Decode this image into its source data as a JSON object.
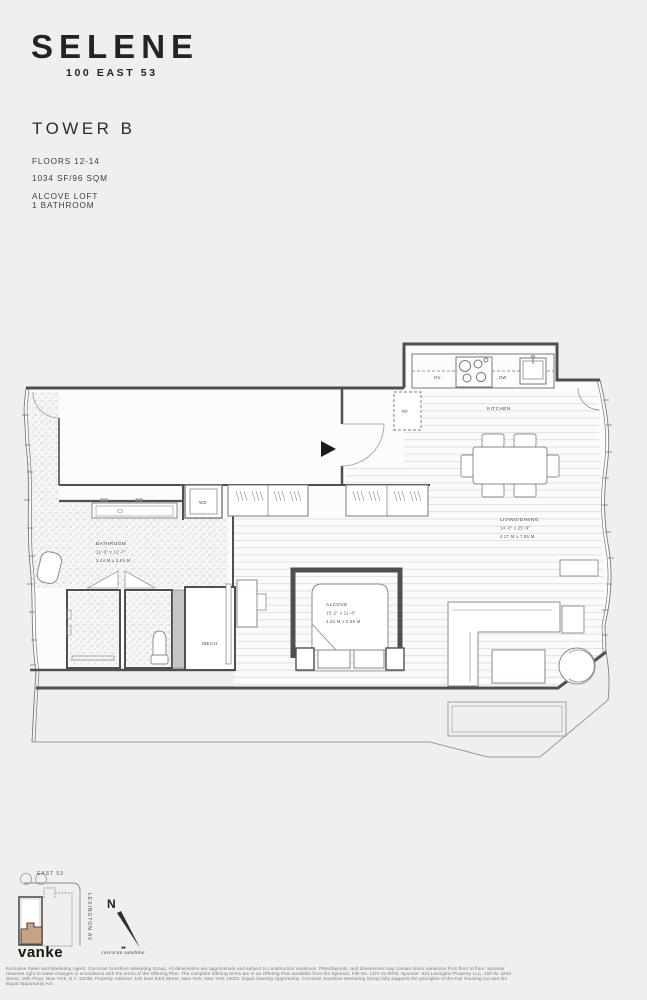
{
  "header": {
    "brand": "SELENE",
    "address": "100 EAST 53",
    "tower": "TOWER B",
    "floors": "FLOORS 12-14",
    "area": "1034 SF/96 SQM",
    "type1": "ALCOVE LOFT",
    "type2": "1 BATHROOM"
  },
  "plan": {
    "labels": {
      "kitchen": "KITCHEN",
      "living_name": "LIVING/DINING",
      "living_ft": "14'-0\" x 25'-9\"",
      "living_m": "4.27 M x 7.85 M",
      "alcove_name": "ALCOVE",
      "alcove_ft": "15'-2\" x 11'-8\"",
      "alcove_m": "4.62 M x 3.56 M",
      "bathroom_name": "BATHROOM",
      "bathroom_ft": "11'-3\" x 12'-7\"",
      "bathroom_m": "3.44 M x 3.84 M",
      "mech": "MECH",
      "wd": "WD",
      "rf": "RF",
      "ov": "OV",
      "dw": "DW"
    }
  },
  "keyplan": {
    "street_top": "EAST 53",
    "street_right": "LEXINGTON AV",
    "north_label": "N",
    "highlight_color": "#c9a183"
  },
  "footer": {
    "brand_logo": "vanke",
    "agency_dots": "●●",
    "agency_logo": "corcoran sunshine",
    "disclaimer": "Exclusive Sales and Marketing Agent: Corcoran Sunshine Marketing Group. All dimensions are approximate and subject to construction variances. Plans/layouts, and dimensions may contain minor variations from floor to floor. Sponsor reserves right to make changes in accordance with the terms of the Offering Plan. The complete offering terms are in an Offering Plan available from the Sponsor. File No. CD# 15-0075. Sponsor: 610 Lexington Property LLC, 150 W. 42nd Street, 16th Floor, New York, N.Y. 10036. Property Address: 100 East 53rd Street, New York, New York 10022. Equal Housing Opportunity. Corcoran Sunshine Marketing Group fully supports the principles of the Fair Housing Act and the Equal Opportunity Act."
  },
  "colors": {
    "page_bg": "#efefee",
    "unit_fill": "#fcfcfb",
    "wall": "#4f4f4f",
    "keyplan_highlight": "#c9a183"
  }
}
